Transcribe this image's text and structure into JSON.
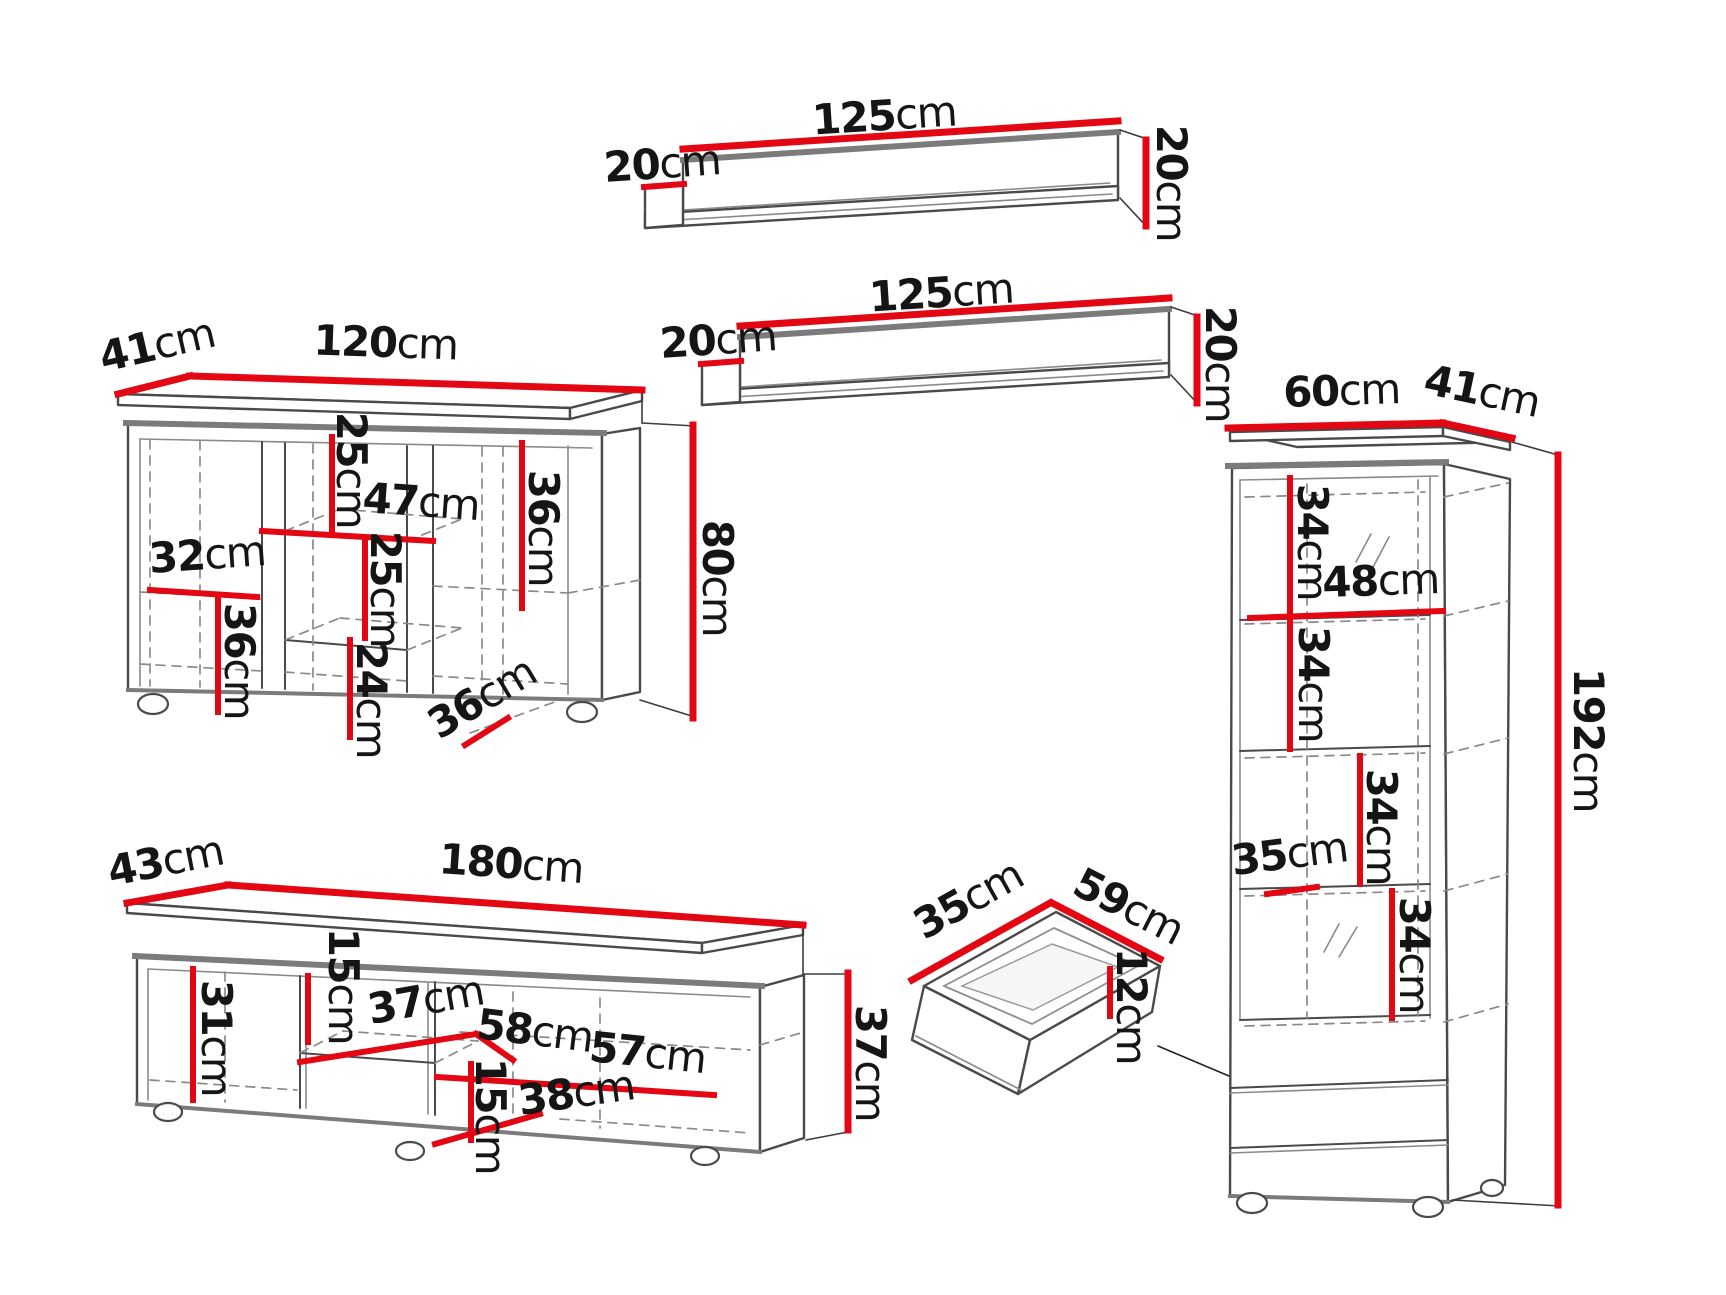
{
  "meta": {
    "doc_type": "furniture-dimension-diagram",
    "unit": "cm",
    "pieces_count": 6
  },
  "colors": {
    "dimension_line": "#e30613",
    "outline": "#4a4a4a",
    "outline_soft": "#7b7b7b",
    "hidden_edge": "#8a8a8a",
    "text": "#151515",
    "background": "#ffffff"
  },
  "pieces": {
    "shelf_top": {
      "name": "wall-shelf",
      "width": {
        "v": "125",
        "u": "cm"
      },
      "depth": {
        "v": "20",
        "u": "cm"
      },
      "height": {
        "v": "20",
        "u": "cm"
      }
    },
    "shelf_bottom": {
      "name": "wall-shelf",
      "width": {
        "v": "125",
        "u": "cm"
      },
      "depth": {
        "v": "20",
        "u": "cm"
      },
      "height": {
        "v": "20",
        "u": "cm"
      }
    },
    "sideboard": {
      "name": "sideboard",
      "depth": {
        "v": "41",
        "u": "cm"
      },
      "width": {
        "v": "120",
        "u": "cm"
      },
      "height": {
        "v": "80",
        "u": "cm"
      },
      "inner": {
        "top_section": {
          "v": "25",
          "u": "cm"
        },
        "middle_width": {
          "v": "47",
          "u": "cm"
        },
        "middle_section": {
          "v": "25",
          "u": "cm"
        },
        "left_width": {
          "v": "32",
          "u": "cm"
        },
        "left_section": {
          "v": "36",
          "u": "cm"
        },
        "bottom_section": {
          "v": "24",
          "u": "cm"
        },
        "base_depth": {
          "v": "36",
          "u": "cm"
        },
        "right_section": {
          "v": "36",
          "u": "cm"
        }
      }
    },
    "tv_stand": {
      "name": "tv-stand",
      "depth": {
        "v": "43",
        "u": "cm"
      },
      "width": {
        "v": "180",
        "u": "cm"
      },
      "height": {
        "v": "37",
        "u": "cm"
      },
      "inner": {
        "left_section": {
          "v": "31",
          "u": "cm"
        },
        "niche_top": {
          "v": "15",
          "u": "cm"
        },
        "niche_width": {
          "v": "37",
          "u": "cm"
        },
        "shelf_depth": {
          "v": "58",
          "u": "cm"
        },
        "right_width": {
          "v": "57",
          "u": "cm"
        },
        "niche_bottom": {
          "v": "15",
          "u": "cm"
        },
        "base_width": {
          "v": "38",
          "u": "cm"
        }
      }
    },
    "drawer": {
      "name": "drawer",
      "front_width": {
        "v": "35",
        "u": "cm"
      },
      "depth": {
        "v": "59",
        "u": "cm"
      },
      "height": {
        "v": "12",
        "u": "cm"
      }
    },
    "cabinet": {
      "name": "display-cabinet",
      "width": {
        "v": "60",
        "u": "cm"
      },
      "depth": {
        "v": "41",
        "u": "cm"
      },
      "height": {
        "v": "192",
        "u": "cm"
      },
      "inner": {
        "section1": {
          "v": "34",
          "u": "cm"
        },
        "inner_width": {
          "v": "48",
          "u": "cm"
        },
        "section2": {
          "v": "34",
          "u": "cm"
        },
        "section3": {
          "v": "34",
          "u": "cm"
        },
        "shelf_depth": {
          "v": "35",
          "u": "cm"
        },
        "section4": {
          "v": "34",
          "u": "cm"
        }
      }
    }
  }
}
